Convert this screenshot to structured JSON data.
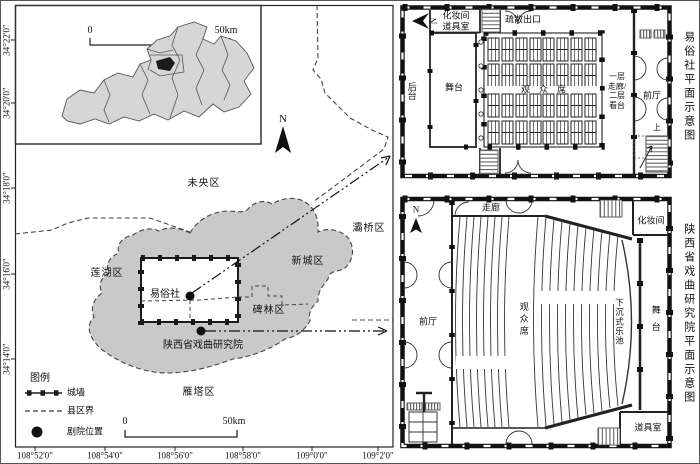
{
  "map": {
    "y_labels": [
      "34°22'0\"",
      "34°20'0\"",
      "34°18'0\"",
      "34°16'0\"",
      "34°14'0\""
    ],
    "x_labels": [
      "108°52'0\"",
      "108°54'0\"",
      "108°56'0\"",
      "108°58'0\"",
      "109°0'0\"",
      "109°2'0\""
    ],
    "north": "N",
    "scale": {
      "zero": "0",
      "fifty": "50km"
    },
    "districts": {
      "weiyang": "未央区",
      "baqiao": "灞桥区",
      "xincheng": "新城区",
      "lianhu": "莲湖区",
      "beilin": "碑林区",
      "yanta": "雁塔区"
    },
    "theaters": {
      "yisu": "易俗社",
      "research": "陕西省戏曲研究院"
    },
    "legend": {
      "title": "图例",
      "wall": "城墙",
      "boundary": "县区界",
      "location": "剧院位置"
    }
  },
  "plan_yisu": {
    "title": "易俗社平面示意图",
    "north": "N",
    "makeup": "化妆间",
    "props": "道具室",
    "exit": "疏散出口",
    "backstage": "后台",
    "stage": "舞台",
    "audience": "观众席",
    "corridor_note": "一层\n走廊/\n二层\n看台",
    "lobby": "前厅",
    "up": "上"
  },
  "plan_research": {
    "title": "陕西省戏曲研究院平面示意图",
    "north": "N",
    "corridor": "走廊",
    "makeup": "化妆间",
    "lobby": "前厅",
    "audience": "观众席",
    "pit": "下沉式乐池",
    "stage": "舞台",
    "props": "道具室"
  }
}
